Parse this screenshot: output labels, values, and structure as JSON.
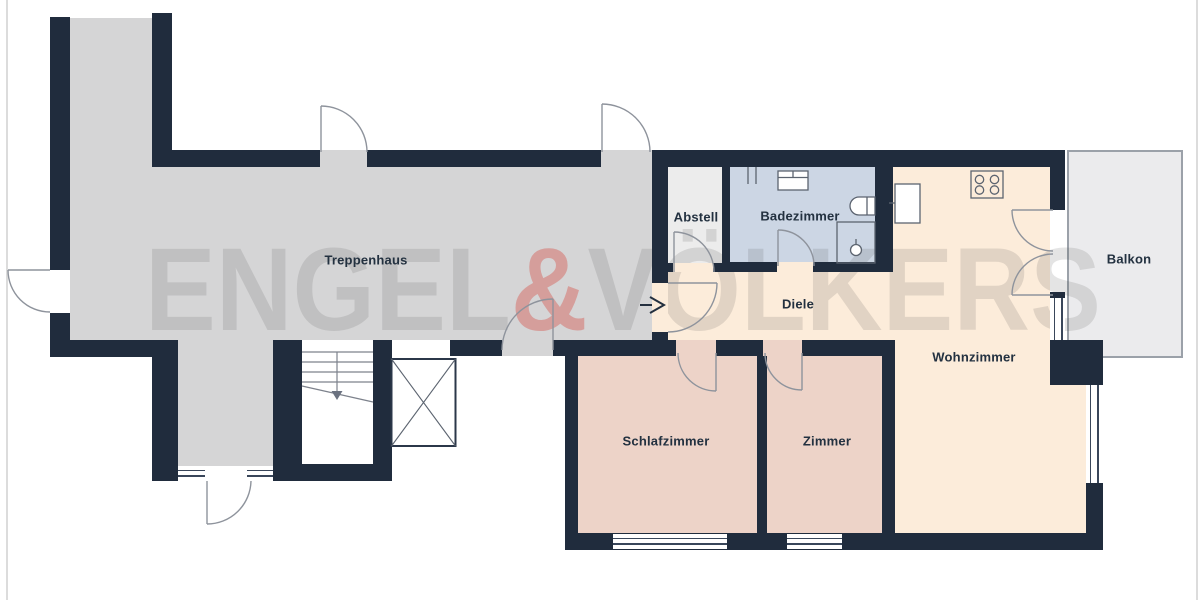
{
  "plan": {
    "watermark": {
      "left": "ENGEL",
      "ampersand": "&",
      "right": "VÖLKERS"
    },
    "rooms": {
      "treppenhaus": {
        "label": "Treppenhaus"
      },
      "abstell": {
        "label": "Abstell"
      },
      "badezimmer": {
        "label": "Badezimmer"
      },
      "diele": {
        "label": "Diele"
      },
      "balkon": {
        "label": "Balkon"
      },
      "wohnzimmer": {
        "label": "Wohnzimmer"
      },
      "schlafzimmer": {
        "label": "Schlafzimmer"
      },
      "zimmer": {
        "label": "Zimmer"
      }
    },
    "colors": {
      "wall": "#202c3d",
      "stairwell_floor": "#d5d5d6",
      "storage_floor": "#ececec",
      "bathroom_floor": "#ccd6e4",
      "hallway_floor": "#fcecda",
      "bedroom_floor": "#edd3c8",
      "balcony_floor": "#ebebed",
      "balcony_border": "#9ba1a9",
      "door_line": "#8e939c",
      "watermark_gray": "rgba(74,74,74,0.15)",
      "watermark_red": "rgba(212,68,60,0.38)"
    },
    "fixtures": [
      "stove",
      "refrigerator",
      "washbasin",
      "toilet",
      "shower",
      "radiator",
      "elevator",
      "staircase",
      "entrance-arrow"
    ]
  }
}
